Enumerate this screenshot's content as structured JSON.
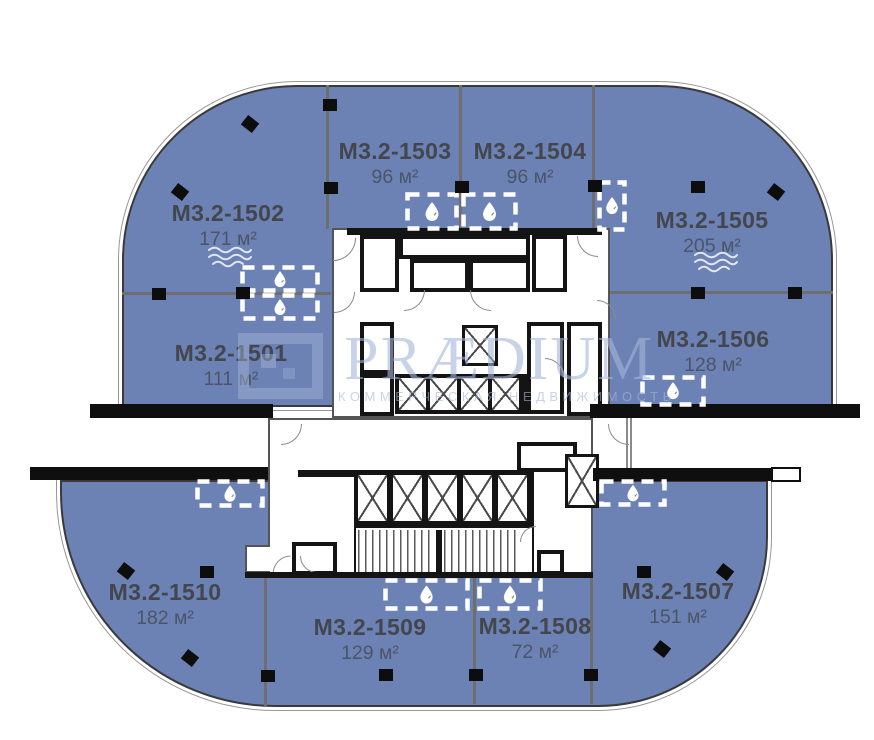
{
  "watermark": {
    "title": "PRÆDIUM",
    "subtitle": "КОММЕРЧЕСКАЯ НЕДВИЖИМОСТЬ",
    "logo_icon": "praedium-square-logo"
  },
  "units": {
    "u1501": {
      "code": "М3.2-1501",
      "area": "111 м²"
    },
    "u1502": {
      "code": "М3.2-1502",
      "area": "171 м²",
      "feature": "water-waves"
    },
    "u1503": {
      "code": "М3.2-1503",
      "area": "96 м²"
    },
    "u1504": {
      "code": "М3.2-1504",
      "area": "96 м²"
    },
    "u1505": {
      "code": "М3.2-1505",
      "area": "205 м²",
      "feature": "water-waves"
    },
    "u1506": {
      "code": "М3.2-1506",
      "area": "128 м²"
    },
    "u1507": {
      "code": "М3.2-1507",
      "area": "151 м²"
    },
    "u1508": {
      "code": "М3.2-1508",
      "area": "72 м²"
    },
    "u1509": {
      "code": "М3.2-1509",
      "area": "129 м²"
    },
    "u1510": {
      "code": "М3.2-1510",
      "area": "182 м²"
    }
  },
  "icons": {
    "wet_point": "water-drop-icon",
    "waves": "water-waves-icon",
    "column": "column-marker"
  },
  "colors": {
    "unit_fill": "#6d82b4",
    "wall_black": "#111111",
    "divider_gray": "#6e6e6e",
    "label_text": "#43464d",
    "area_text": "#5a5f66",
    "watermark_blue": "#c3cfe6"
  }
}
